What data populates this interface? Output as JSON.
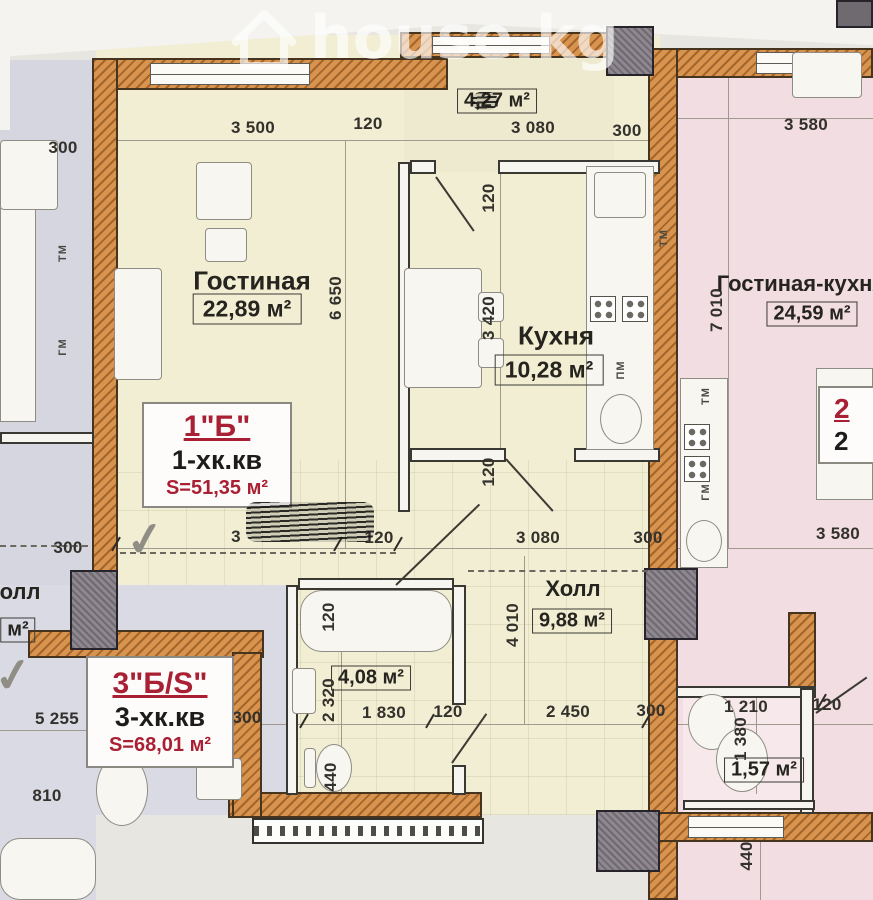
{
  "watermark": {
    "text": "house.kg"
  },
  "apartments": {
    "apt1": {
      "name": "1\"Б\"",
      "type": "1-хк.кв",
      "area": "S=51,35 м²"
    },
    "apt3": {
      "name": "3\"Б/S\"",
      "type": "3-хк.кв",
      "area": "S=68,01 м²"
    },
    "apt2": {
      "name": "2",
      "type": "2"
    }
  },
  "rooms": {
    "living": {
      "label": "Гостиная",
      "area": "22,89 м²"
    },
    "kitchen": {
      "label": "Кухня",
      "area": "10,28 м²"
    },
    "hall": {
      "label": "Холл",
      "area": "9,88 м²"
    },
    "bathroom": {
      "area": "4,08 м²"
    },
    "balcony": {
      "area": "4,27 м²"
    },
    "living_kitchen": {
      "label": "Гостиная-кухня",
      "area": "24,59 м²"
    },
    "wc_right": {
      "area": "1,57 м²"
    },
    "hall_left": {
      "label": "олл",
      "area": "м²"
    }
  },
  "appliances": {
    "tm": "ТМ",
    "gm": "ГМ",
    "pm": "ПМ"
  },
  "dims": {
    "t300l": "300",
    "t3500": "3 500",
    "t120": "120",
    "t3080": "3 080",
    "t300r": "300",
    "t3580": "3 580",
    "v6650": "6 650",
    "v3420": "3 420",
    "v120k": "120",
    "v7010": "7 010",
    "v120h": "120",
    "v4010": "4 010",
    "l300": "300",
    "m3": "3",
    "m120": "120",
    "m3080": "3 080",
    "m300": "300",
    "m3580": "3 580",
    "b5255": "5 255",
    "bl300": "300",
    "b1830": "1 830",
    "b120": "120",
    "b2450": "2 450",
    "b300": "300",
    "r1210": "1 210",
    "r120": "120",
    "l810": "810",
    "v2320": "2 320",
    "v120b": "120",
    "v1380": "1 380",
    "v440l": "440",
    "v440r": "440"
  },
  "colors": {
    "wall_orange": "#d8944e",
    "cream": "#f1eed3",
    "pink": "#f2dde2",
    "lavender": "#d6d6e1",
    "label_red": "#a91f33",
    "column_grey": "#8e8790"
  }
}
